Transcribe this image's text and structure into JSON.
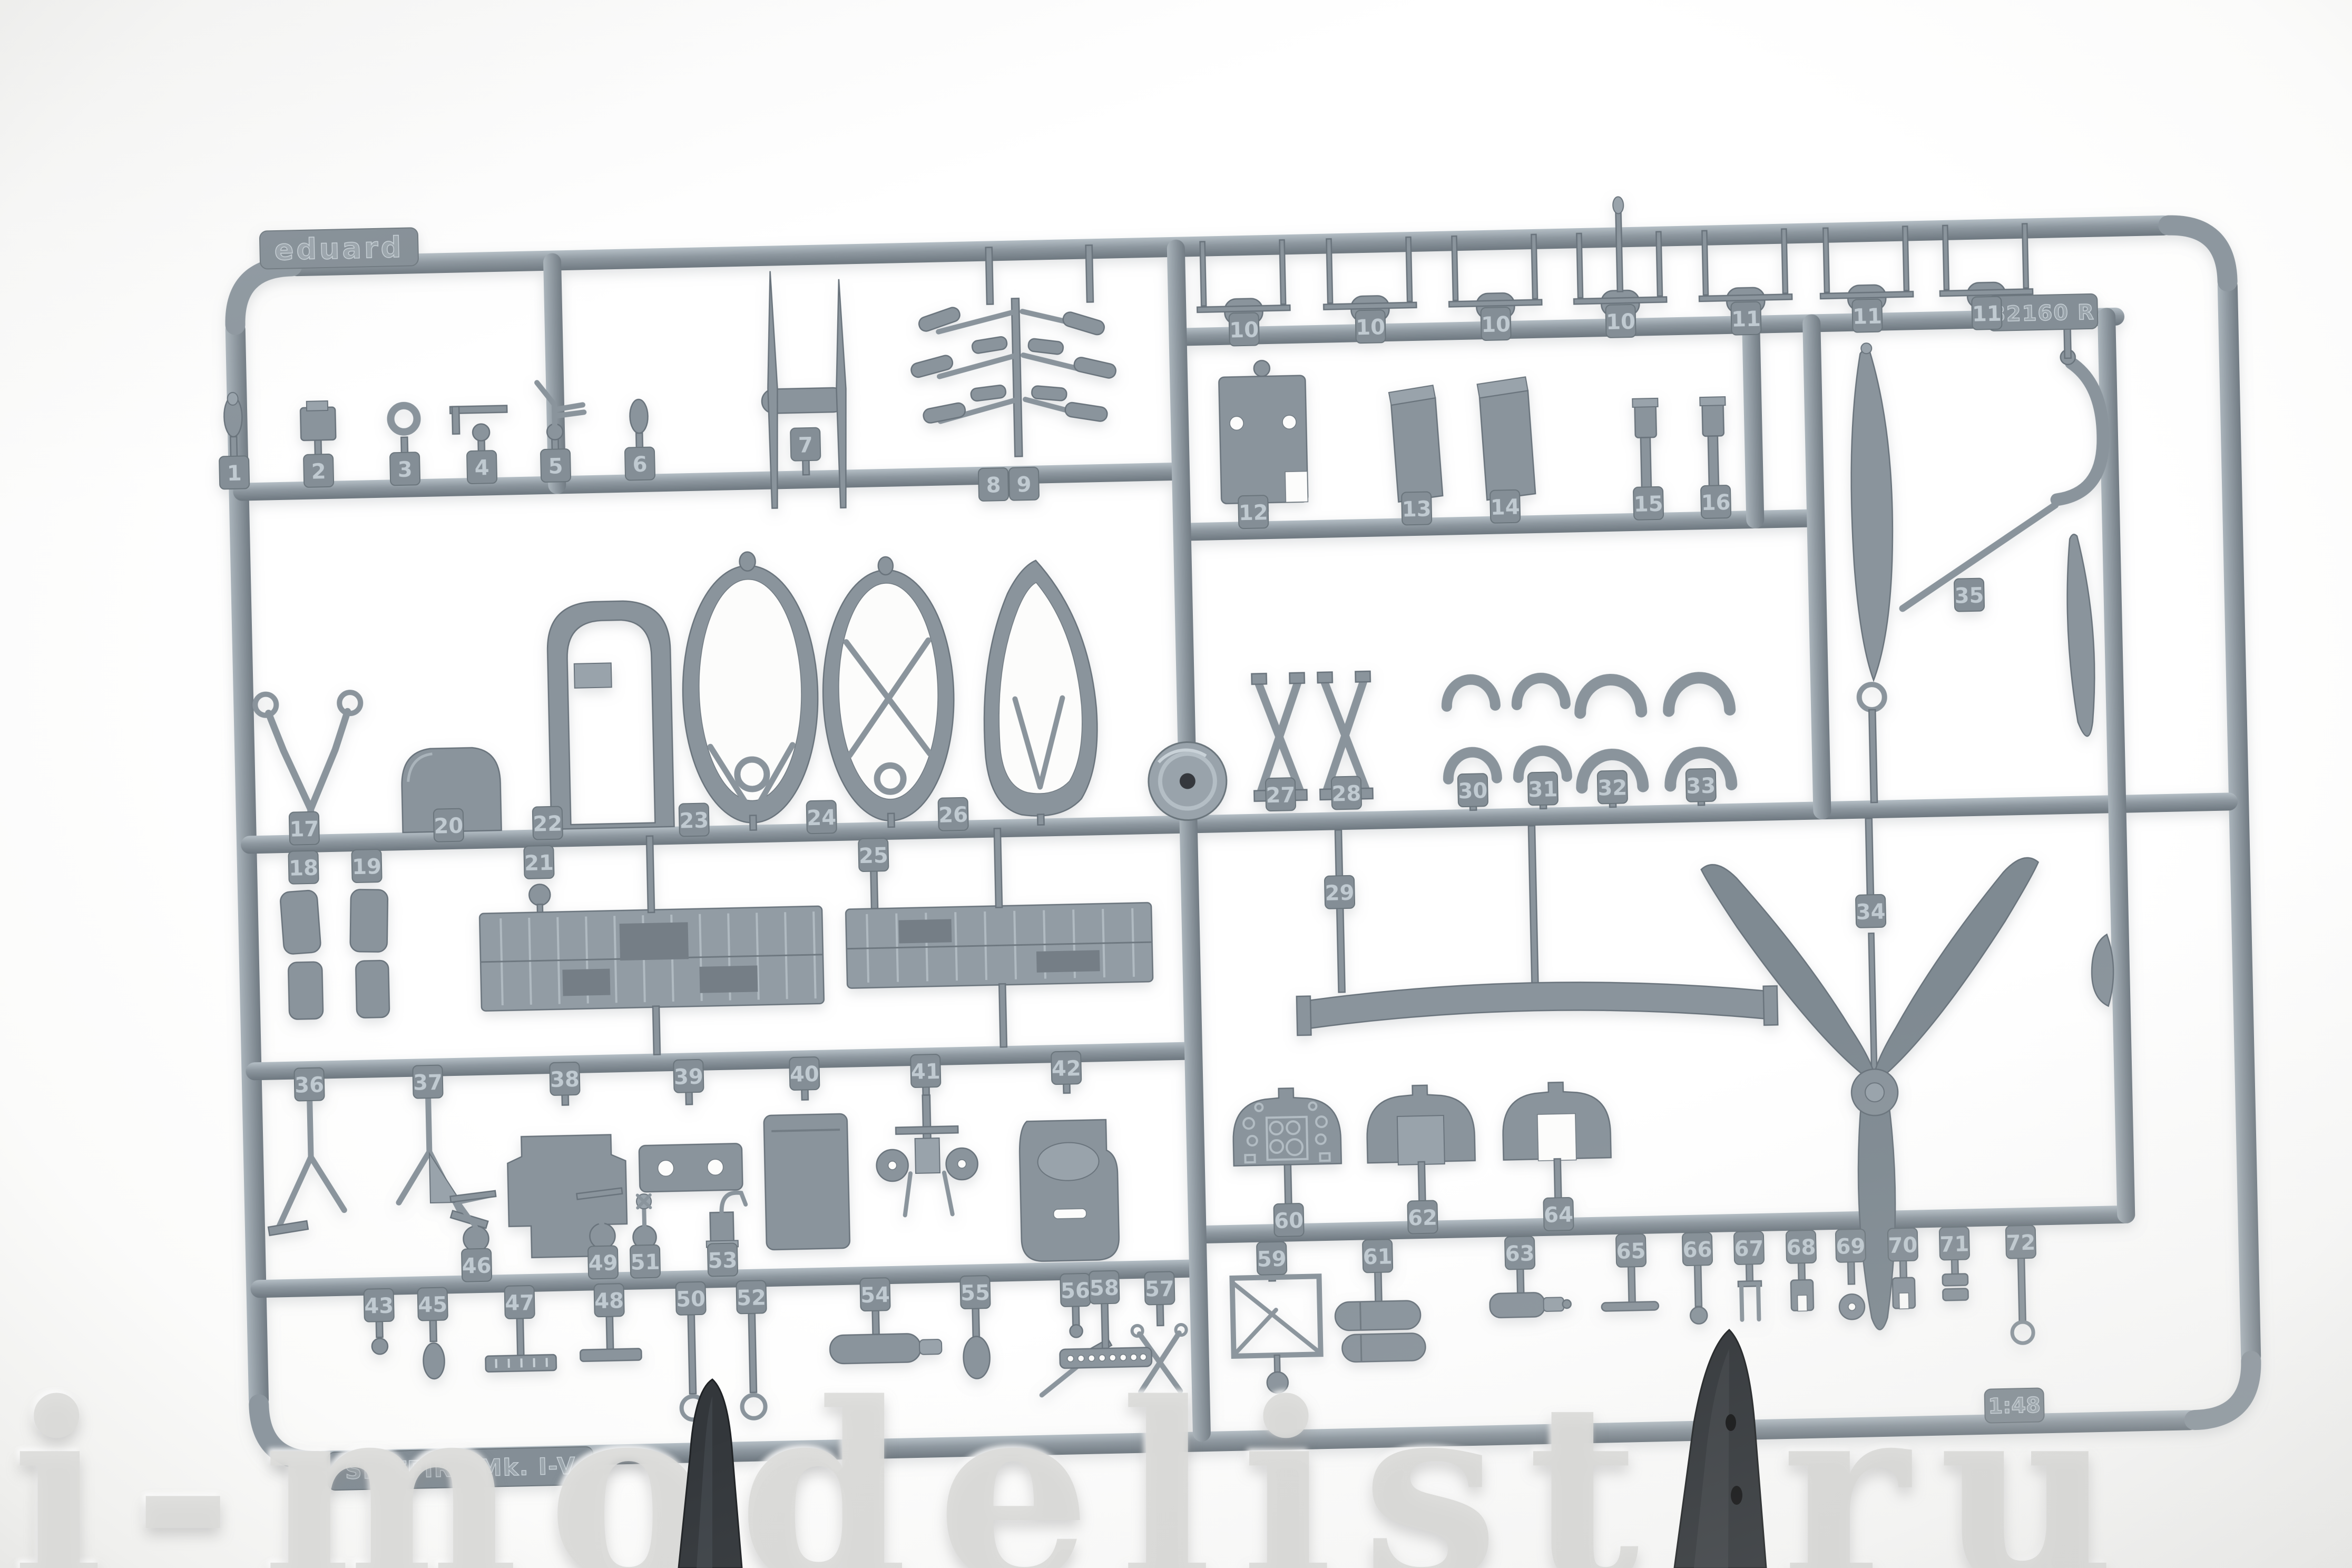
{
  "photo": {
    "subject": "Eduard injection-molded plastic model sprue, gray styrene parts frame on white background",
    "brand_tag": "eduard",
    "sprue_code_tag": "82160 R",
    "kit_name_tag": "SPITFIRE Mk. I-V",
    "scale_tag": "1:48",
    "watermark": "i-modelist.ru",
    "plastic_color": "#8a949c",
    "plastic_highlight": "#b7c1c8",
    "plastic_shadow": "#5f6970",
    "background_color": "#fbfbfa",
    "dark_part_color": "#33373b"
  },
  "part_rows": {
    "top_left_row": [
      "1",
      "2",
      "3",
      "4",
      "5",
      "6"
    ],
    "antenna_mast": [
      "7"
    ],
    "exhaust_stacks": [
      "8",
      "9"
    ],
    "top_right_row": [
      "10",
      "10",
      "10",
      "10",
      "11",
      "11",
      "11"
    ],
    "right_upper_row": [
      "12",
      "13",
      "14",
      "15",
      "16"
    ],
    "formers_above_left": [
      "17",
      "20",
      "22",
      "23",
      "24",
      "26"
    ],
    "formers_below_left": [
      "18",
      "19",
      "21",
      "25"
    ],
    "formers_above_right": [
      "27",
      "28",
      "30",
      "31",
      "32",
      "33"
    ],
    "formers_below_right": [
      "29"
    ],
    "propeller": [
      "34"
    ],
    "crutch_assembly": [
      "35"
    ],
    "lower_left_row": [
      "36",
      "37",
      "38",
      "39",
      "40",
      "41",
      "42"
    ],
    "pump_row_above": [
      "46",
      "49",
      "51",
      "53"
    ],
    "pump_row_below": [
      "43",
      "45",
      "47",
      "48",
      "50",
      "52",
      "54",
      "55",
      "56",
      "57"
    ],
    "strip_tag": [
      "58"
    ],
    "panel_row_above": [
      "60",
      "62",
      "64"
    ],
    "bottom_right_row": [
      "59",
      "61",
      "63",
      "65",
      "66",
      "67",
      "68",
      "69",
      "70",
      "71",
      "72"
    ]
  }
}
